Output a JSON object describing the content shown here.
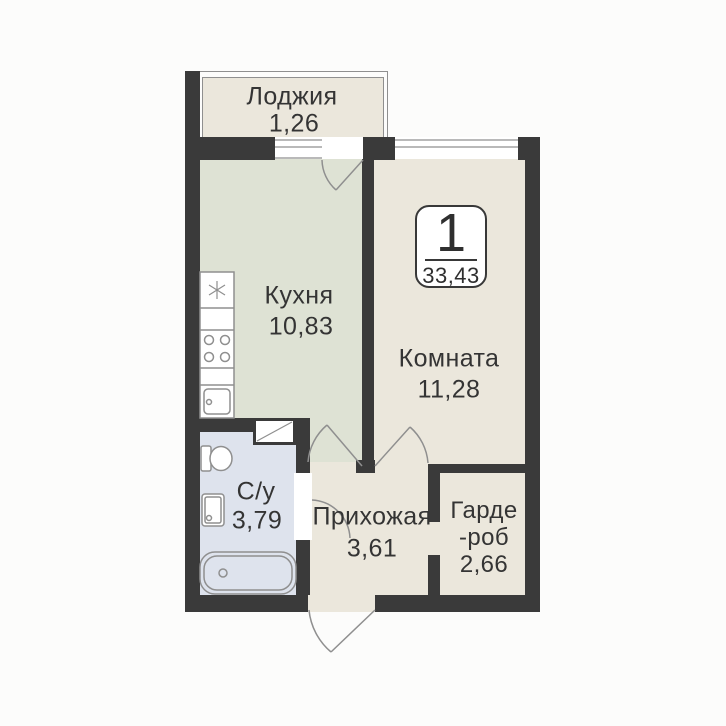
{
  "plan_title": "apartment-floor-plan",
  "badge": {
    "rooms_count": "1",
    "total_area": "33,43"
  },
  "rooms": {
    "loggia": {
      "label": "Лоджия",
      "area": "1,26"
    },
    "kitchen": {
      "label": "Кухня",
      "area": "10,83"
    },
    "room": {
      "label": "Комната",
      "area": "11,28"
    },
    "bathroom": {
      "label": "С/у",
      "area": "3,79"
    },
    "hallway": {
      "label": "Прихожая",
      "area": "3,61"
    },
    "wardrobe": {
      "label_line1": "Гарде",
      "label_line2": "-роб",
      "area": "2,66"
    }
  },
  "fixtures": {
    "fridge_icon": "snowflake-asterisk",
    "stove_icon": "four-burner-circles",
    "kitchen_sink_icon": "basin-with-drain",
    "toilet_icon": "toilet-top-view",
    "washbasin_icon": "square-basin",
    "bathtub_icon": "bathtub-top-view",
    "vent_icon": "diagonal-shaft"
  },
  "colors": {
    "wall": "#3a3a3a",
    "kitchen": "#dee2d4",
    "cream": "#ebe7dc",
    "bath": "#dee3ed",
    "line": "#8f8f8f",
    "text": "#343434"
  }
}
